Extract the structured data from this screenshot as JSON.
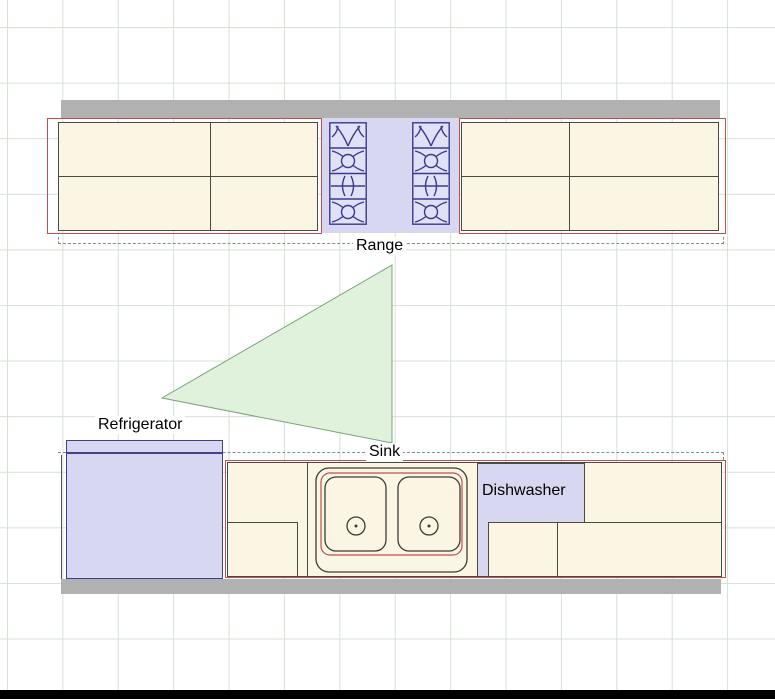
{
  "plan": {
    "labels": {
      "range": "Range",
      "refrigerator": "Refrigerator",
      "sink": "Sink",
      "dishwasher": "Dishwasher"
    },
    "colors": {
      "counter_fill": "#fbf5e3",
      "counter_outline": "#4a4a42",
      "selection_red": "#c14f4f",
      "appliance_fill": "#d7d7f1",
      "appliance_outline": "#40408c",
      "wall_gray": "#b1b1b1",
      "work_triangle_fill": "#e0f1dc",
      "work_triangle_stroke": "#77a577",
      "grid_line": "#d4e2d4",
      "label_text": "#000000"
    }
  }
}
